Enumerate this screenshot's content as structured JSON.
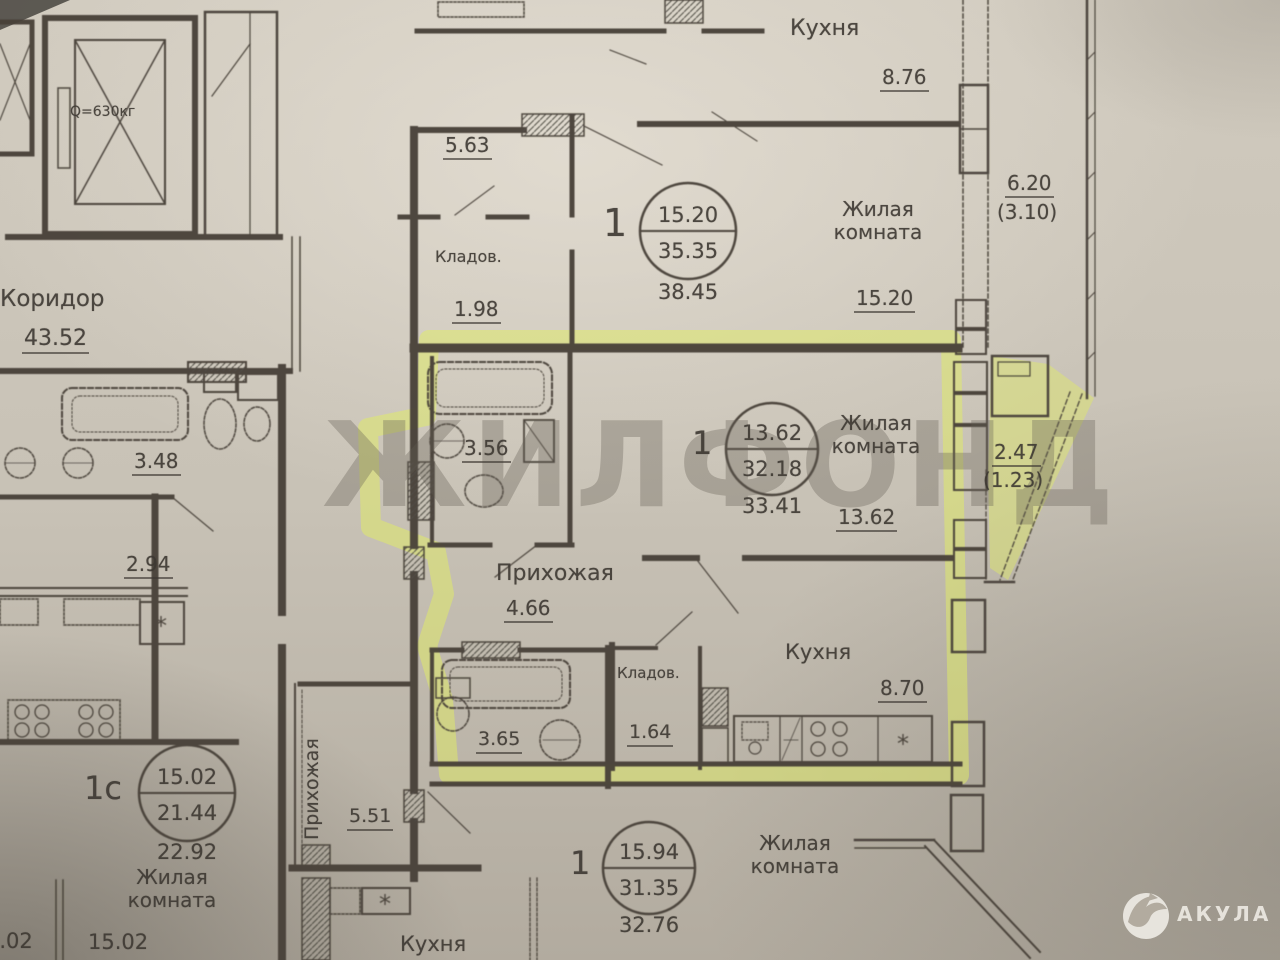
{
  "watermark": "ЖИЛФОНД",
  "logo": {
    "name": "АКУЛА"
  },
  "symbols": {
    "fridge": "*"
  },
  "core": {
    "elevator_capacity": "Q=630кг"
  },
  "left_apt": {
    "corridor": {
      "name": "Коридор",
      "area": "43.52"
    },
    "bathroom_area": "3.48",
    "hall_area": "2.94",
    "stamp": {
      "rooms": "1с",
      "living": "15.02",
      "total": "21.44",
      "total_alt": "22.92"
    },
    "living_room": {
      "name": "Жилая комната",
      "area": "15.02"
    },
    "edge_partial": "5.02"
  },
  "apt_top": {
    "hall_area": "5.63",
    "storage": {
      "name": "Кладов.",
      "area": "1.98"
    },
    "stamp": {
      "rooms": "1",
      "living": "15.20",
      "total": "35.35",
      "total_alt": "38.45"
    },
    "living_room": {
      "name": "Жилая комната",
      "area": "15.20"
    },
    "kitchen": {
      "name": "Кухня",
      "area": "8.76"
    },
    "balcony": {
      "area": "6.20",
      "reduced": "(3.10)"
    }
  },
  "apt_mid": {
    "stamp": {
      "rooms": "1",
      "living": "13.62",
      "total": "32.18",
      "total_alt": "33.41"
    },
    "living_room": {
      "name": "Жилая комната",
      "area": "13.62"
    },
    "kitchen": {
      "name": "Кухня",
      "area": "8.70"
    },
    "bathroom_area": "3.56",
    "hallway": {
      "name": "Прихожая",
      "area": "4.66"
    },
    "storage": {
      "name": "Кладов.",
      "area": "1.64"
    },
    "balcony": {
      "area": "2.47",
      "reduced": "(1.23)"
    }
  },
  "apt_bottom": {
    "stamp": {
      "rooms": "1",
      "living": "15.94",
      "total": "31.35",
      "total_alt": "32.76"
    },
    "living_room": {
      "name": "Жилая комната"
    },
    "kitchen": {
      "name": "Кухня"
    },
    "hallway": {
      "name": "Прихожая",
      "area": "5.51"
    },
    "bathroom_area": "3.65"
  }
}
